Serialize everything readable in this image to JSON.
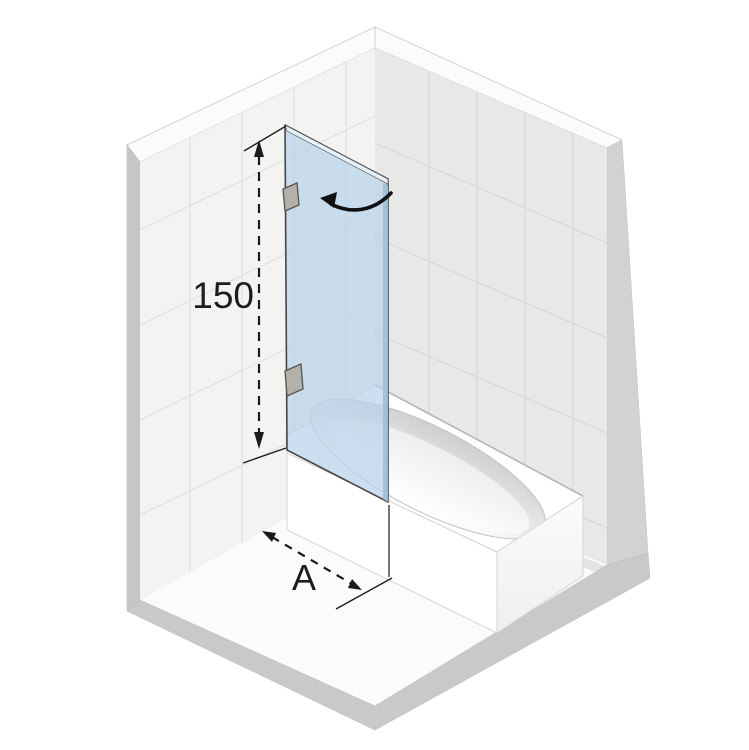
{
  "scene": {
    "name": "Bath screen installation diagram",
    "dimensions": {
      "height": {
        "label": "150"
      },
      "width": {
        "label": "A"
      }
    },
    "colors": {
      "background": "#ffffff",
      "left_wall_face": "#f3f3f1",
      "right_wall_face": "#e8e8e6",
      "grout_left": "#dfdfdd",
      "grout_right": "#d6d6d4",
      "wall_left_edge": "#c6c6c4",
      "wall_right_edge": "#d2d2d0",
      "wall_top_band": "#fbfbfa",
      "floor": "#fbfbf9",
      "floor_slab_edge": "#c9c9c7",
      "glass_fill": "#b7d2ea",
      "glass_thickness_edge": "#9fbeda",
      "glass_top_sliver": "#e8f1f9",
      "glass_outline": "#474747",
      "tub_white": "#ffffff",
      "tub_shade": "#f6f6f4",
      "basin_shade": "#cfcfcd",
      "tub_outline": "#d5d5d3",
      "hinge_fill": "#b3b1a8",
      "hinge_outline": "#55534d",
      "dimension_ink": "#1c1c1c"
    },
    "elements": [
      "left-wall",
      "right-wall",
      "floor",
      "bathtub",
      "glass-panel",
      "top-hinge",
      "bottom-hinge",
      "swing-direction-arrow",
      "height-dimension",
      "width-dimension"
    ]
  }
}
